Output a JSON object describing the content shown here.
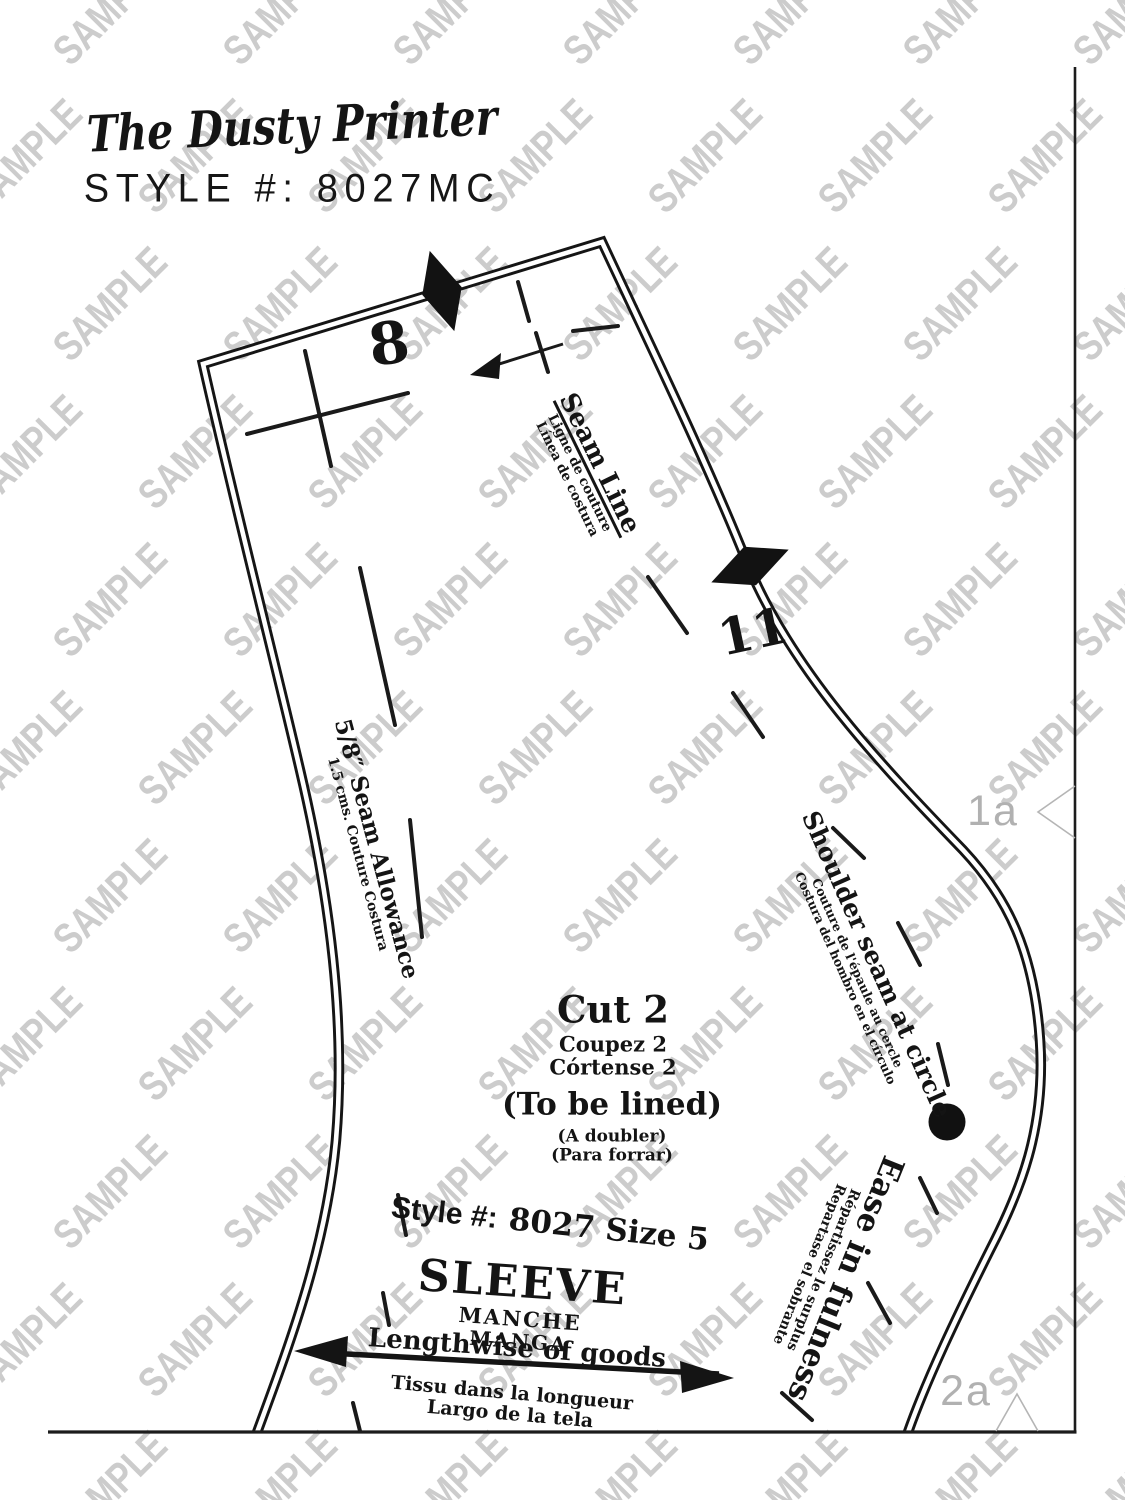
{
  "header": {
    "brand": "The Dusty Printer",
    "style_line": "STYLE #: 8027MC"
  },
  "watermark": {
    "text": "SAMPLE",
    "color": "#cccccc"
  },
  "tile_markers": {
    "right": "1a",
    "bottom": "2a"
  },
  "pattern": {
    "piece_numbers": {
      "top": "8",
      "side": "11"
    },
    "seam_line": {
      "en": "Seam Line",
      "fr": "Ligne de couture",
      "es": "Línea de costura"
    },
    "seam_allowance": {
      "en": "5/8″ Seam Allowance",
      "metric": "1.5 cms. Couture Costura"
    },
    "cut": {
      "en": "Cut 2",
      "fr": "Coupez 2",
      "es": "Córtense 2"
    },
    "lined": {
      "en": "(To be lined)",
      "fr": "(A doubler)",
      "es": "(Para forrar)"
    },
    "style_size": {
      "prefix": "Style #:",
      "value": "8027 Size 5"
    },
    "piece_name": {
      "en": "SLEEVE",
      "fr": "MANCHE",
      "es": "MANGA"
    },
    "grainline": {
      "en": "Lengthwise of goods",
      "fr": "Tissu dans la longueur",
      "es": "Largo de la tela"
    },
    "shoulder": {
      "en": "Shoulder seam at circle",
      "fr": "Couture de l'épaule au cercle",
      "es": "Costura del hombro en el círculo"
    },
    "ease": {
      "en": "Ease in fulness",
      "fr": "Répartissez le surplus",
      "es": "Repartase el sobrante"
    }
  }
}
